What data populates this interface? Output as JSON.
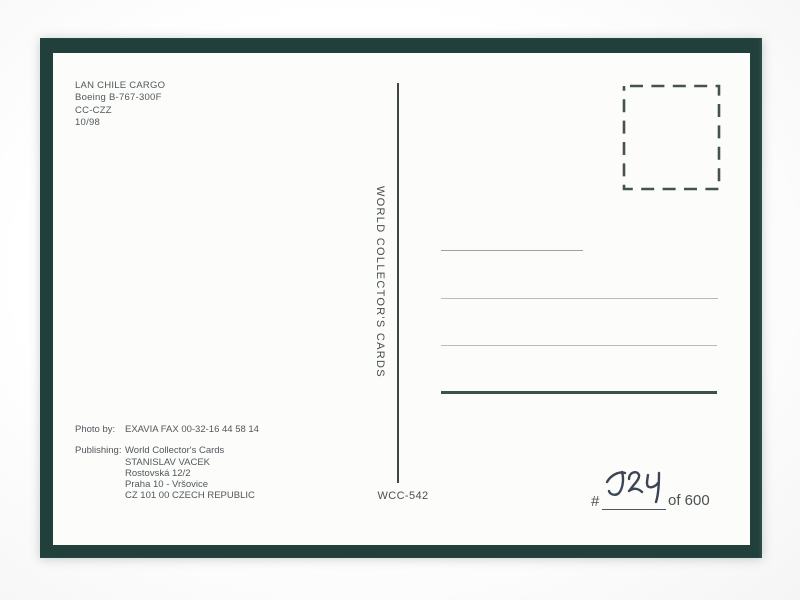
{
  "scan": {
    "frame_color": "#21403b",
    "card_color": "#fcfcfa",
    "text_color": "#4d5452",
    "ink_color": "#3b4553"
  },
  "aircraft_info": {
    "lines": [
      "LAN CHILE CARGO",
      "Boeing B-767-300F",
      "CC-CZZ",
      "10/98"
    ]
  },
  "publisher_vertical_text": "WORLD COLLECTOR'S CARDS",
  "card_number": "WCC-542",
  "credits": {
    "photo_label": "Photo by:",
    "photo_value": "EXAVIA FAX 00-32-16 44 58 14",
    "publishing_label": "Publishing:",
    "publishing_lines": [
      "World Collector's Cards",
      "STANISLAV VACEK",
      "Rostovská 12/2",
      "Praha 10 - Vršovice",
      "CZ 101 00 CZECH REPUBLIC"
    ]
  },
  "numbering": {
    "prefix": "#",
    "written_number": "524",
    "suffix": "of 600"
  }
}
